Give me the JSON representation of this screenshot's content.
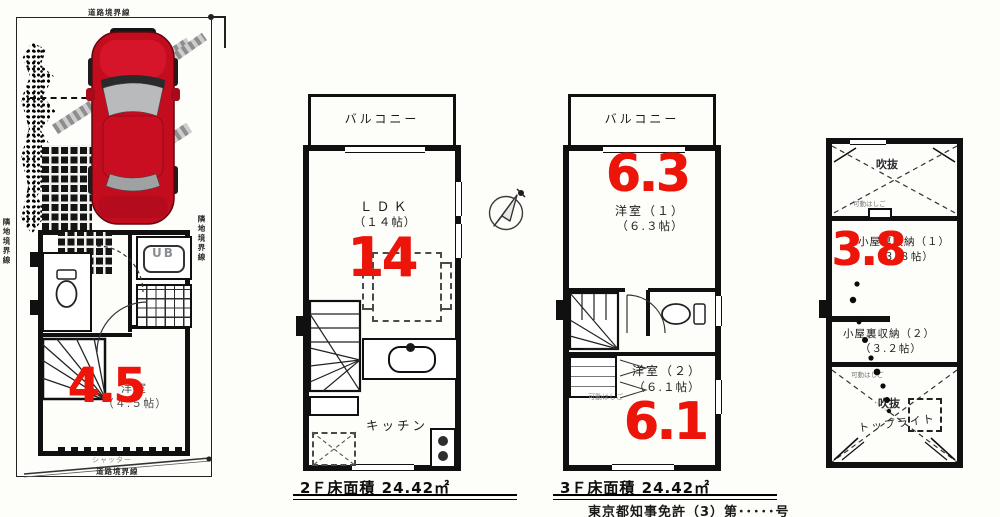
{
  "sheet": {
    "background": "#fdfdfa"
  },
  "colors": {
    "accent_red": "#ed1509",
    "wall_black": "#101010",
    "car_red": "#c30d1f"
  },
  "icons": {
    "compass": "north-compass-arrow",
    "car": "red-car-top-view"
  },
  "site_plan": {
    "boundary_top_label": "道路境界線",
    "boundary_left_label": "隣地境界線",
    "boundary_right_label": "隣地境界線",
    "ub_label": "UB",
    "room_name": "洋室",
    "room_size": "（４.５帖）",
    "room_number": "4.5",
    "shutter_label": "シャッター",
    "boundary_bottom_label": "道路境界線"
  },
  "floor2": {
    "balcony_label": "バルコニー",
    "ldk_name": "ＬＤＫ",
    "ldk_size": "（１４帖）",
    "ldk_number": "14",
    "kitchen_label": "キッチン",
    "area_text": "2Ｆ床面積 24.42㎡"
  },
  "floor3": {
    "balcony_label": "バルコニー",
    "room1_name": "洋室（１）",
    "room1_size": "（６.３帖）",
    "room1_number": "6.3",
    "ladder_label": "可動はしご",
    "room2_name": "洋室（２）",
    "room2_size": "（６.１帖）",
    "room2_number": "6.1",
    "area_text": "3Ｆ床面積 24.42㎡"
  },
  "attic": {
    "void_top_label": "吹抜",
    "ladder_top_label": "可動はしご",
    "storage1_name": "小屋裏収納（１）",
    "storage1_size": "（３.８帖）",
    "storage1_number": "3.8",
    "storage2_name": "小屋裏収納（２）",
    "storage2_size": "（３.２帖）",
    "ladder_bottom_label": "可動はしご",
    "void_bottom_label": "吹抜",
    "toplight_label": "トップライト"
  },
  "footer": {
    "license_text": "東京都知事免許（3）第･････号"
  }
}
